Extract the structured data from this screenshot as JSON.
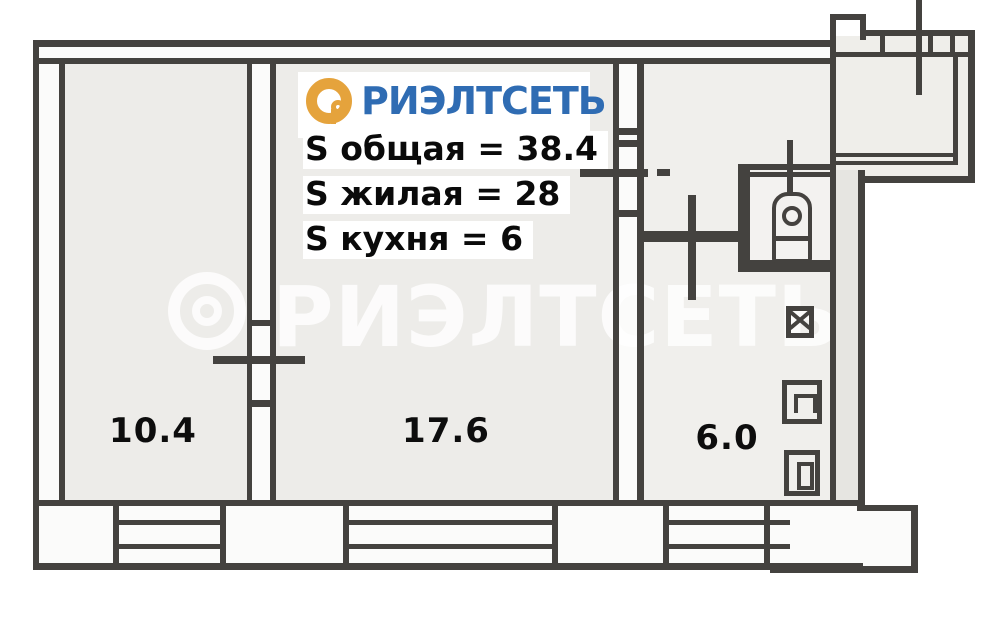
{
  "logo": {
    "brand": "РИЭЛТСЕТЬ",
    "icon": "p-in-circle-icon",
    "blue": "#2F6CB3",
    "orange": "#E5A33C"
  },
  "area_summary": {
    "total": "S общая = 38.4",
    "living": "S жилая = 28",
    "kitchen": "S кухня = 6"
  },
  "room_labels": {
    "room1": "10.4",
    "room2": "17.6",
    "kitchen": "6.0"
  },
  "watermark": {
    "brand": "РИЭЛТСЕТЬ"
  },
  "colors": {
    "wall": "#44423F",
    "room_fill": "#EDECE9",
    "text": "#0A0A0A"
  },
  "fixtures": {
    "toilet": "toilet",
    "sink": "sink",
    "stove": "stove",
    "cabinet": "cabinet"
  }
}
